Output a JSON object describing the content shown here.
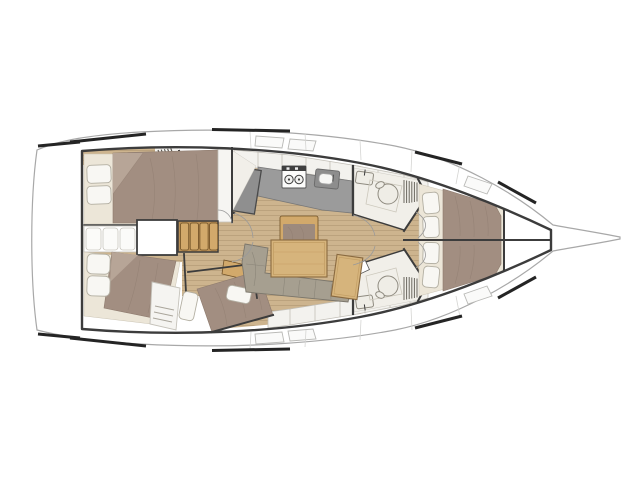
{
  "meta": {
    "title": "Sailing yacht interior layout floor plan, top-down view, bow pointing right",
    "type": "floorplan",
    "drawing_has_text": false
  },
  "palette": {
    "hull-outline": "#a8a8a8",
    "structure": "#3c3c3c",
    "toe-rail": "#242424",
    "floor-wood": "#cdb48e",
    "floor-wood-line": "#b49b75",
    "trim-wood": "#d2a96b",
    "trim-wood-dark": "#6f5026",
    "table-wood": "#d6b47c",
    "table-edge": "#8a6a40",
    "mattress": "#a28e81",
    "mattress-light": "#b7a597",
    "mattress-line": "#8d7a6d",
    "bed-base": "#ece6d8",
    "pillow": "#f8f7f3",
    "pillow-edge": "#b3afa2",
    "cabinet": "#f3f2ee",
    "cabinet-edge": "#c2bfb7",
    "counter": "#9b9b9b",
    "counter-edge": "#787878",
    "appliance": "#8f8f8f",
    "fixture": "#efede6",
    "fixture-edge": "#8f8b80",
    "settee": "#a69f90",
    "settee-edge": "#7b766b",
    "head-floor": "#f1efe9",
    "deck-seam": "#d5d5d3",
    "arc": "#9a9a9a",
    "hatch": "#fafaf9",
    "hatch-edge": "#b9b9b6"
  },
  "components": [
    "hull",
    "bowsprit",
    "transom",
    "side-decks",
    "toe-rail-sections",
    "deck-hatches",
    "aft-port-cabin-double-bed",
    "companionway-steps",
    "engine-hatch",
    "stern-lockers",
    "aft-head-toilet-sink-shower",
    "galley-counter",
    "galley-stove",
    "galley-sink",
    "galley-fridge",
    "salon-table",
    "salon-chair",
    "salon-l-settee",
    "chart-table",
    "starboard-aft-cabin-1-angled-bed",
    "starboard-aft-cabin-2-angled-bed",
    "wardrobe-drawers",
    "forward-head-port",
    "forward-head-starboard",
    "shower-grates",
    "forward-vberth-split-two-cabins",
    "four-pillows",
    "bow-anchor-locker",
    "door-swing-arcs"
  ]
}
